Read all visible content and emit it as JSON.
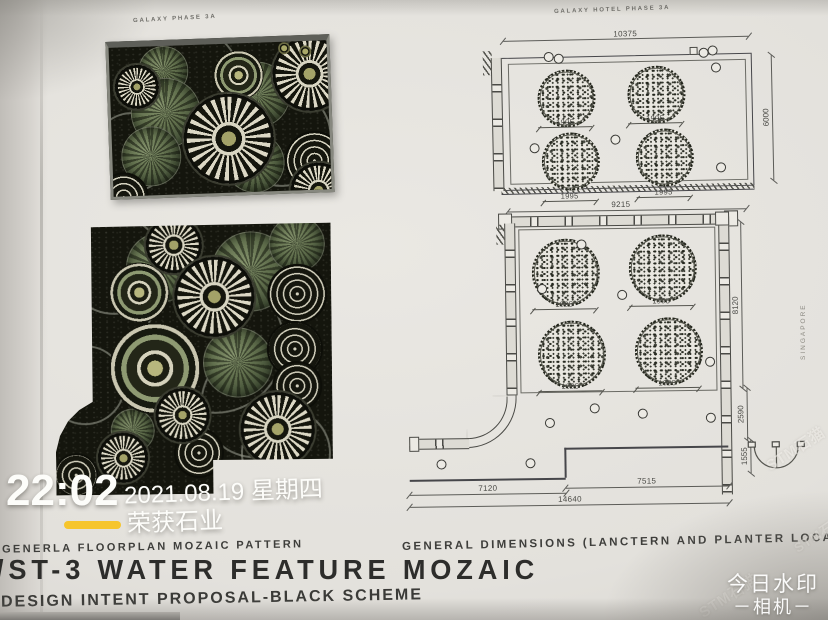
{
  "photo": {
    "left_page": {
      "plate_label": "GALAXY PHASE 3A",
      "caption": "GENERLA FLOORPLAN MOZAIC PATTERN",
      "title": "/ST-3 WATER FEATURE MOZAIC",
      "subtitle": "DESIGN INTENT PROPOSAL-BLACK SCHEME",
      "scheme_colors": {
        "mosaic_background": "#14150d",
        "mosaic_green": "#687753",
        "mosaic_white": "#dcd8c5"
      }
    },
    "right_page": {
      "plate_label": "GALAXY HOTEL PHASE 3A",
      "caption": "GENERAL DIMENSIONS (LANCTERN AND PLANTER LOCATION)",
      "side_text": "SINGAPORE",
      "drawing_upper": {
        "dim_top": "10375",
        "dim_right": "6000",
        "planter_dims": [
          "1995",
          "1995",
          "1995",
          "1995"
        ]
      },
      "drawing_lower": {
        "dim_top": "9215",
        "dim_right_upper": "8120",
        "dim_right_mid": "2590",
        "dim_right_lower": "1555",
        "dim_bottom_left": "7120",
        "dim_bottom_right": "7515",
        "dim_bottom_total": "14640",
        "planter_dims": [
          "1995",
          "1995",
          "1995",
          "1995"
        ]
      }
    },
    "watermark": {
      "time": "22:02",
      "date": "2021.08.19 星期四",
      "brand": "荣获石业",
      "app_name": "今日水印",
      "app_sub": "－相机－",
      "diagonal": "STM石猫",
      "accent_color": "#f6c52c"
    }
  }
}
